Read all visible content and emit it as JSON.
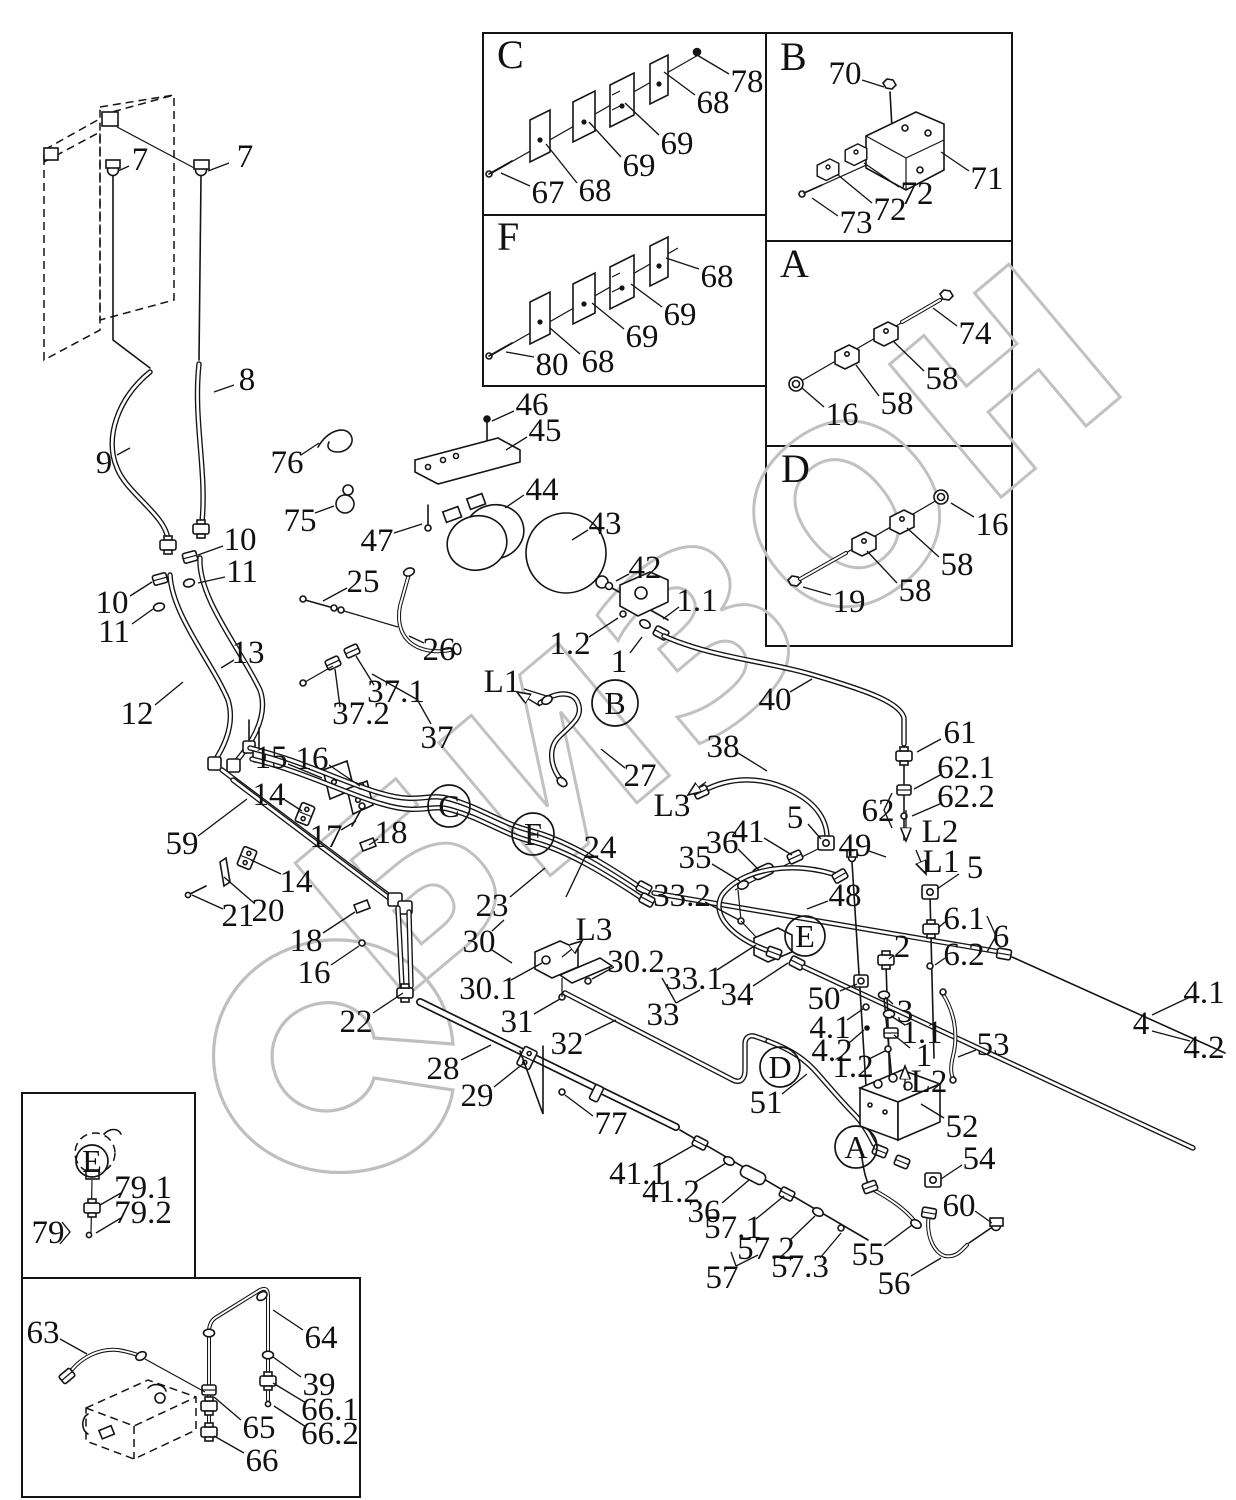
{
  "watermark": {
    "text": "БИЗОН",
    "color": "#c1c1c1"
  },
  "insets": [
    {
      "letter": "C",
      "x": 497,
      "y": 68
    },
    {
      "letter": "F",
      "x": 497,
      "y": 250
    },
    {
      "letter": "B",
      "x": 780,
      "y": 70
    },
    {
      "letter": "A",
      "x": 780,
      "y": 277
    },
    {
      "letter": "D",
      "x": 781,
      "y": 482
    }
  ],
  "ref_circles": [
    {
      "letter": "B",
      "x": 615,
      "y": 703,
      "r": 23
    },
    {
      "letter": "C",
      "x": 449,
      "y": 806,
      "r": 21
    },
    {
      "letter": "F",
      "x": 533,
      "y": 834,
      "r": 21
    },
    {
      "letter": "E",
      "x": 805,
      "y": 936,
      "r": 20
    },
    {
      "letter": "D",
      "x": 780,
      "y": 1067,
      "r": 20
    },
    {
      "letter": "A",
      "x": 856,
      "y": 1147,
      "r": 21
    },
    {
      "letter": "E",
      "x": 92,
      "y": 1161,
      "r": 16
    }
  ],
  "arrows": [
    {
      "t": "L1",
      "tx": 502,
      "ty": 681,
      "x1": 540,
      "y1": 706,
      "x2": 517,
      "y2": 692
    },
    {
      "t": "L3",
      "tx": 672,
      "ty": 805,
      "x1": 706,
      "y1": 782,
      "x2": 688,
      "y2": 795
    },
    {
      "t": "L3",
      "tx": 594,
      "ty": 929,
      "x1": 562,
      "y1": 957,
      "x2": 582,
      "y2": 941
    },
    {
      "t": "L1",
      "tx": 941,
      "ty": 861,
      "x1": 916,
      "y1": 850,
      "x2": 926,
      "y2": 874
    },
    {
      "t": "L2",
      "tx": 940,
      "ty": 831,
      "x1": 906,
      "y1": 810,
      "x2": 906,
      "y2": 841
    },
    {
      "t": "L2",
      "tx": 929,
      "ty": 1081,
      "x1": 905,
      "y1": 1090,
      "x2": 905,
      "y2": 1066
    }
  ],
  "labels": [
    [
      "78",
      747,
      81,
      729,
      74,
      697,
      55
    ],
    [
      "68",
      713,
      102,
      695,
      95,
      664,
      72
    ],
    [
      "69",
      677,
      143,
      659,
      135,
      625,
      103
    ],
    [
      "69",
      639,
      165,
      621,
      157,
      589,
      122
    ],
    [
      "68",
      595,
      190,
      577,
      183,
      546,
      144
    ],
    [
      "67",
      548,
      192,
      530,
      186,
      501,
      173
    ],
    [
      "80",
      552,
      364,
      534,
      357,
      506,
      352
    ],
    [
      "68",
      598,
      361,
      580,
      354,
      550,
      328
    ],
    [
      "69",
      642,
      336,
      624,
      329,
      592,
      303
    ],
    [
      "69",
      680,
      314,
      662,
      307,
      631,
      284
    ],
    [
      "68",
      717,
      276,
      699,
      269,
      666,
      258
    ],
    [
      "70",
      845,
      73,
      862,
      80,
      884,
      87
    ],
    [
      "71",
      987,
      178,
      969,
      171,
      941,
      152
    ],
    [
      "72",
      917,
      193,
      899,
      187,
      864,
      163
    ],
    [
      "72",
      890,
      209,
      872,
      203,
      838,
      175
    ],
    [
      "73",
      856,
      222,
      838,
      216,
      812,
      198
    ],
    [
      "74",
      975,
      333,
      957,
      326,
      933,
      308
    ],
    [
      "58",
      942,
      378,
      924,
      371,
      894,
      342
    ],
    [
      "58",
      897,
      403,
      879,
      396,
      856,
      365
    ],
    [
      "16",
      842,
      414,
      824,
      407,
      802,
      388
    ],
    [
      "16",
      992,
      524,
      974,
      517,
      951,
      503
    ],
    [
      "58",
      957,
      564,
      939,
      557,
      907,
      528
    ],
    [
      "58",
      915,
      590,
      897,
      583,
      867,
      551
    ],
    [
      "19",
      849,
      601,
      831,
      595,
      803,
      587
    ],
    [
      "7",
      140,
      159,
      129,
      166,
      118,
      171
    ],
    [
      "7",
      245,
      156,
      229,
      163,
      208,
      171
    ],
    [
      "8",
      247,
      379,
      234,
      385,
      214,
      392
    ],
    [
      "9",
      104,
      462,
      117,
      455,
      130,
      448
    ],
    [
      "10",
      240,
      539,
      223,
      546,
      198,
      555
    ],
    [
      "11",
      242,
      571,
      225,
      577,
      198,
      583
    ],
    [
      "10",
      112,
      602,
      130,
      596,
      152,
      582
    ],
    [
      "11",
      114,
      631,
      132,
      624,
      153,
      609
    ],
    [
      "13",
      248,
      652,
      234,
      660,
      221,
      668
    ],
    [
      "12",
      137,
      713,
      155,
      705,
      183,
      682
    ],
    [
      "76",
      287,
      462,
      301,
      455,
      319,
      443
    ],
    [
      "75",
      300,
      520,
      315,
      513,
      334,
      506
    ],
    [
      "46",
      532,
      404,
      514,
      411,
      492,
      421
    ],
    [
      "45",
      545,
      430,
      527,
      437,
      506,
      450
    ],
    [
      "44",
      542,
      489,
      524,
      495,
      505,
      508
    ],
    [
      "47",
      377,
      540,
      394,
      533,
      422,
      524
    ],
    [
      "43",
      605,
      523,
      588,
      530,
      572,
      540
    ],
    [
      "42",
      645,
      567,
      629,
      574,
      616,
      581
    ],
    [
      "25",
      363,
      581,
      347,
      588,
      323,
      601
    ],
    [
      "26",
      439,
      649,
      424,
      643,
      409,
      636
    ],
    [
      "37.1",
      396,
      691,
      374,
      685,
      356,
      656
    ],
    [
      "37.2",
      361,
      713,
      340,
      707,
      335,
      669
    ],
    [
      "37",
      437,
      737,
      431,
      724,
      418,
      701
    ],
    [
      "1.1",
      697,
      600,
      679,
      607,
      663,
      619
    ],
    [
      "1.2",
      570,
      643,
      589,
      637,
      618,
      618
    ],
    [
      "1",
      619,
      661,
      630,
      653,
      642,
      637
    ],
    [
      "40",
      775,
      699,
      790,
      692,
      812,
      679
    ],
    [
      "27",
      640,
      775,
      625,
      768,
      601,
      749
    ],
    [
      "38",
      723,
      746,
      738,
      753,
      767,
      771
    ],
    [
      "61",
      960,
      732,
      941,
      739,
      917,
      752
    ],
    [
      "62.1",
      966,
      767,
      942,
      774,
      914,
      789
    ],
    [
      "62.2",
      966,
      796,
      942,
      803,
      912,
      816
    ],
    [
      "62",
      878,
      810
    ],
    [
      "49",
      855,
      845,
      869,
      851,
      886,
      857
    ],
    [
      "5",
      975,
      867,
      959,
      874,
      937,
      889
    ],
    [
      "6.1",
      964,
      918,
      945,
      922,
      938,
      928
    ],
    [
      "6.2",
      964,
      954,
      945,
      958,
      935,
      965
    ],
    [
      "6",
      1001,
      936
    ],
    [
      "2",
      902,
      946,
      894,
      955,
      889,
      959
    ],
    [
      "48",
      845,
      895,
      828,
      901,
      807,
      909
    ],
    [
      "50",
      824,
      998,
      840,
      991,
      857,
      984
    ],
    [
      "3",
      905,
      1011,
      893,
      1004,
      885,
      997
    ],
    [
      "4.1",
      830,
      1027,
      847,
      1020,
      863,
      1009
    ],
    [
      "4.2",
      832,
      1050,
      849,
      1043,
      864,
      1030
    ],
    [
      "1.1",
      922,
      1032,
      905,
      1025,
      891,
      1016
    ],
    [
      "1",
      924,
      1055,
      910,
      1048,
      894,
      1035
    ],
    [
      "1.2",
      853,
      1066,
      869,
      1059,
      885,
      1051
    ],
    [
      "53",
      993,
      1044,
      976,
      1050,
      958,
      1057
    ],
    [
      "51",
      766,
      1102,
      782,
      1094,
      807,
      1074
    ],
    [
      "52",
      962,
      1126,
      944,
      1118,
      921,
      1104
    ],
    [
      "54",
      979,
      1158,
      962,
      1165,
      941,
      1179
    ],
    [
      "55",
      868,
      1254,
      884,
      1246,
      912,
      1225
    ],
    [
      "60",
      959,
      1205,
      975,
      1211,
      992,
      1223
    ],
    [
      "56",
      894,
      1283,
      911,
      1276,
      941,
      1258
    ],
    [
      "57.1",
      733,
      1227,
      756,
      1219,
      784,
      1196
    ],
    [
      "57.2",
      766,
      1248,
      790,
      1240,
      815,
      1216
    ],
    [
      "57.3",
      800,
      1266,
      820,
      1258,
      841,
      1233
    ],
    [
      "57",
      722,
      1277
    ],
    [
      "41.1",
      638,
      1173,
      659,
      1165,
      694,
      1145
    ],
    [
      "41.2",
      671,
      1191,
      694,
      1183,
      726,
      1163
    ],
    [
      "36",
      704,
      1211,
      722,
      1203,
      749,
      1180
    ],
    [
      "35",
      695,
      857,
      712,
      864,
      740,
      881
    ],
    [
      "36",
      722,
      842,
      738,
      849,
      759,
      870
    ],
    [
      "41",
      748,
      831,
      764,
      838,
      792,
      855
    ],
    [
      "5",
      795,
      817,
      808,
      824,
      821,
      839
    ],
    [
      "33.2",
      682,
      895,
      705,
      902,
      739,
      920
    ],
    [
      "33.1",
      694,
      978,
      717,
      970,
      756,
      945
    ],
    [
      "34",
      737,
      994,
      753,
      986,
      788,
      963
    ],
    [
      "33",
      663,
      1014
    ],
    [
      "30.2",
      636,
      961,
      614,
      967,
      592,
      979
    ],
    [
      "31",
      517,
      1021,
      534,
      1014,
      560,
      999
    ],
    [
      "30.1",
      488,
      988,
      511,
      980,
      542,
      963
    ],
    [
      "30",
      479,
      941
    ],
    [
      "32",
      567,
      1043,
      585,
      1035,
      616,
      1020
    ],
    [
      "23",
      492,
      905,
      510,
      897,
      545,
      868
    ],
    [
      "24",
      600,
      847,
      586,
      855,
      566,
      897
    ],
    [
      "22",
      356,
      1021,
      373,
      1013,
      403,
      993
    ],
    [
      "28",
      443,
      1068,
      461,
      1060,
      491,
      1045
    ],
    [
      "29",
      477,
      1095,
      494,
      1087,
      524,
      1063
    ],
    [
      "77",
      611,
      1123,
      593,
      1116,
      565,
      1095
    ],
    [
      "59",
      182,
      843,
      198,
      836,
      247,
      799
    ],
    [
      "15",
      271,
      757,
      288,
      764,
      322,
      778
    ],
    [
      "16",
      312,
      758,
      329,
      765,
      360,
      786
    ],
    [
      "14",
      269,
      794,
      285,
      800,
      302,
      811
    ],
    [
      "17",
      326,
      836,
      341,
      830,
      356,
      821
    ],
    [
      "18",
      391,
      832,
      378,
      839,
      369,
      845
    ],
    [
      "14",
      296,
      881,
      281,
      874,
      251,
      860
    ],
    [
      "20",
      268,
      910,
      254,
      903,
      224,
      877
    ],
    [
      "21",
      238,
      915,
      223,
      909,
      192,
      895
    ],
    [
      "18",
      306,
      940,
      323,
      933,
      355,
      912
    ],
    [
      "16",
      314,
      972,
      331,
      965,
      359,
      946
    ],
    [
      "4",
      1141,
      1023
    ],
    [
      "4.1",
      1204,
      992
    ],
    [
      "4.2",
      1204,
      1047
    ],
    [
      "79.1",
      143,
      1187,
      121,
      1193,
      100,
      1205
    ],
    [
      "79.2",
      143,
      1212,
      121,
      1218,
      96,
      1233
    ],
    [
      "79",
      48,
      1232
    ],
    [
      "63",
      43,
      1332,
      60,
      1339,
      87,
      1354
    ],
    [
      "64",
      321,
      1337,
      303,
      1330,
      273,
      1310
    ],
    [
      "39",
      319,
      1384,
      301,
      1377,
      273,
      1357
    ],
    [
      "66.1",
      330,
      1409,
      306,
      1403,
      273,
      1383
    ],
    [
      "66.2",
      330,
      1433,
      306,
      1427,
      274,
      1406
    ],
    [
      "65",
      259,
      1427,
      241,
      1420,
      214,
      1397
    ],
    [
      "66",
      262,
      1460,
      244,
      1453,
      214,
      1436
    ]
  ]
}
